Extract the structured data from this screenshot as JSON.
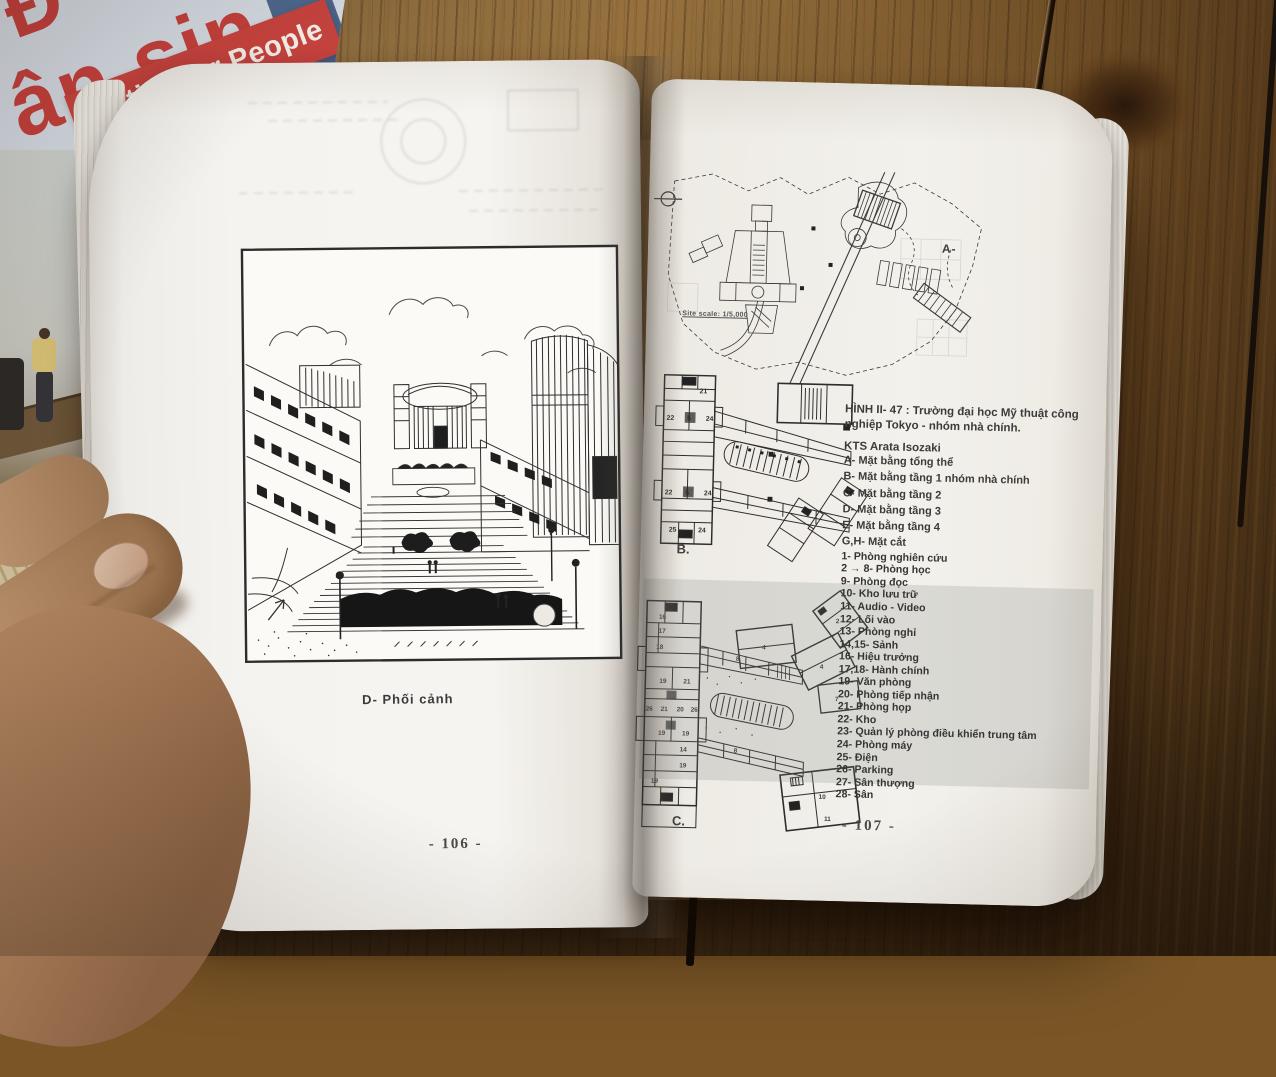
{
  "background": {
    "cover_book": {
      "title_fragment_top": "Đ",
      "title_fragment": "ân sin",
      "banner_text": "Cities for People",
      "spine_text": "DỰNG",
      "banner_color": "#c7433e",
      "title_color": "#c5403c",
      "cover_color": "#d5dbe3"
    }
  },
  "left_page": {
    "figure_caption": "D- Phối cảnh",
    "page_number": "- 106 -"
  },
  "right_page": {
    "page_number": "- 107 -",
    "site_plan": {
      "label": "A-",
      "scale_note": "Site scale: 1/5,000"
    },
    "plan_b": {
      "label": "B.",
      "rooms": [
        "21",
        "22",
        "5",
        "24",
        "22",
        "5",
        "24",
        "25",
        "24"
      ]
    },
    "plan_c": {
      "label": "C.",
      "rooms": [
        "16",
        "17",
        "18",
        "19",
        "21",
        "26",
        "21",
        "20",
        "26",
        "19",
        "19",
        "14",
        "19",
        "19",
        "8",
        "8",
        "4",
        "4",
        "7",
        "2",
        "10",
        "11"
      ]
    },
    "legend": {
      "caption": "HÌNH II- 47 : Trường đại học Mỹ thuật công nghiệp Tokyo - nhóm nhà chính.",
      "architect": "KTS Arata Isozaki",
      "letter_items": [
        "A- Mặt bằng tổng thể",
        "B- Mặt bằng tầng 1 nhóm nhà chính",
        "C- Mặt bằng tầng 2",
        "D- Mặt bằng tầng 3",
        "E- Mặt bằng tầng 4",
        "G,H- Mặt cắt"
      ],
      "number_items": [
        "1- Phòng nghiên cứu",
        "2 → 8- Phòng học",
        "9- Phòng đọc",
        "10- Kho lưu trữ",
        "11- Audio - Video",
        "12- Lối vào",
        "13- Phòng nghỉ",
        "14,15- Sảnh",
        "16- Hiệu trưởng",
        "17,18- Hành chính",
        "19- Văn phòng",
        "20- Phòng tiếp nhận",
        "21- Phòng họp",
        "22- Kho",
        "23- Quản lý phòng điều khiển trung tâm",
        "24- Phòng máy",
        "25- Điện",
        "26- Parking",
        "27- Sân thượng",
        "28- Sân"
      ]
    }
  }
}
